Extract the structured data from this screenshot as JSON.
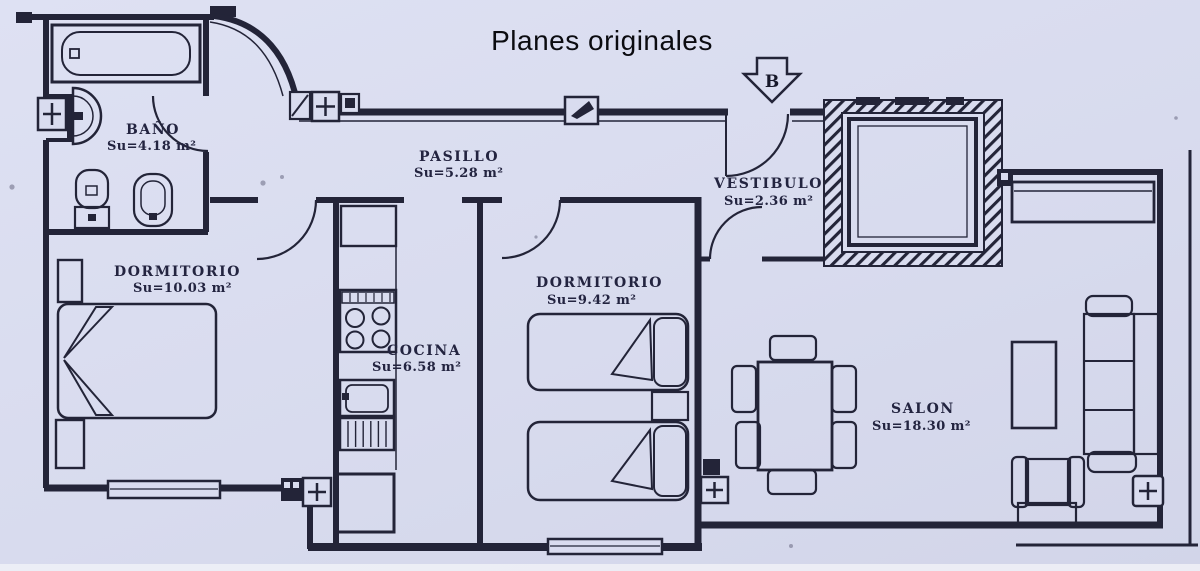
{
  "title": "Planes originales",
  "orientation_arrow_label": "B",
  "rooms": {
    "bano": {
      "name": "BAÑO",
      "area": "Su=4.18 m²"
    },
    "pasillo": {
      "name": "PASILLO",
      "area": "Su=5.28 m²"
    },
    "dormitorio_1": {
      "name": "DORMITORIO",
      "area": "Su=10.03 m²"
    },
    "cocina": {
      "name": "COCINA",
      "area": "Su=6.58 m²"
    },
    "dormitorio_2": {
      "name": "DORMITORIO",
      "area": "Su=9.42 m²"
    },
    "vestibulo": {
      "name": "VESTIBULO",
      "area": "Su=2.36 m²"
    },
    "salon": {
      "name": "SALON",
      "area": "Su=18.30 m²"
    }
  },
  "colors": {
    "paper": "#d8dbee",
    "ink": "#232438"
  }
}
